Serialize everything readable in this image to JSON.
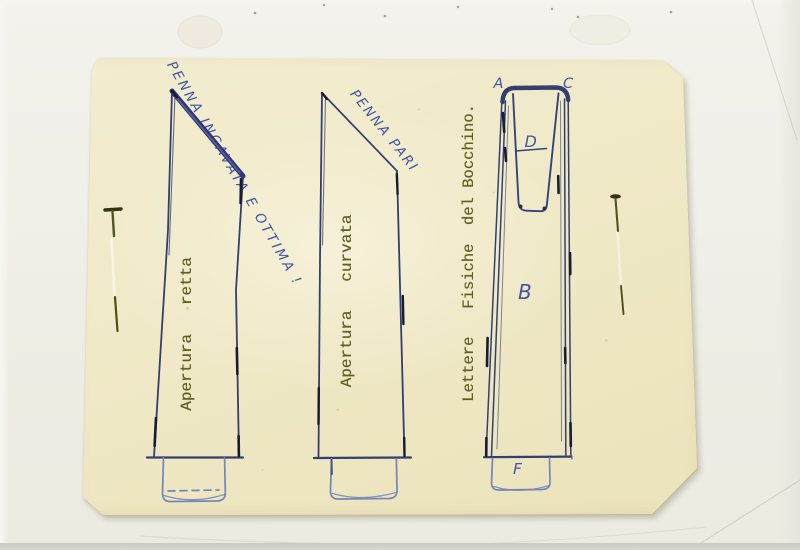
{
  "scan": {
    "annotations": {
      "pen_note_1": "PENNA INCAVATA E OTTIMA !",
      "pen_note_2": "PENNA PARI",
      "caption_straight": "Apertura   retta",
      "caption_curved": "Apertura   curvata",
      "caption_letters": "Lettere   Fisiche  del Bocchino."
    },
    "letters": {
      "a": "A",
      "c": "C",
      "d": "D",
      "b": "B",
      "f": "F",
      "tick": "'"
    },
    "colors": {
      "ink_outline": "#333f6e",
      "ink_heavy": "#161c33",
      "ink_sketch": "#7485b8",
      "handwriting_blue": "#4156a5",
      "typewriter_olive": "#605e22",
      "sheet_cream": "#f0e9c8",
      "backing_white": "#efeee6",
      "pin_olive": "#54551e"
    }
  }
}
